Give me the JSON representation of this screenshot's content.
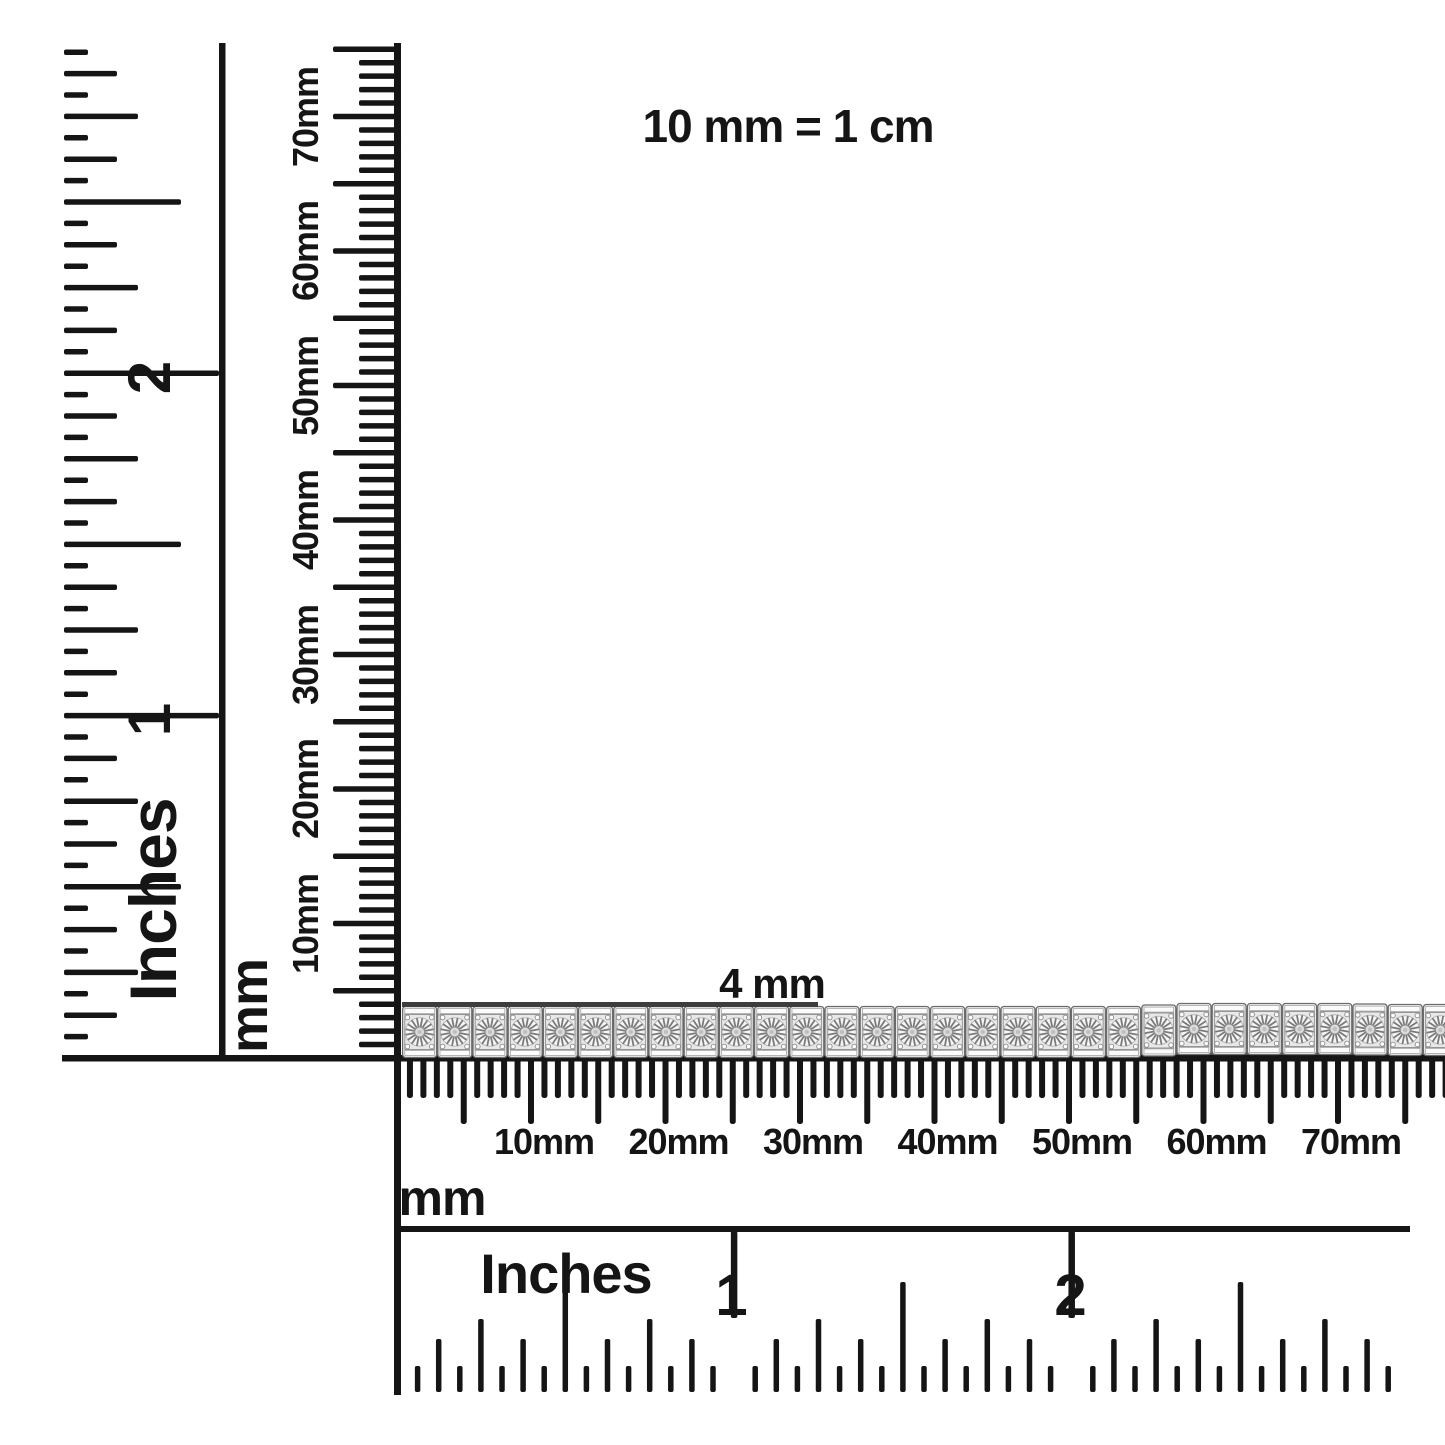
{
  "scale_note": "10 mm = 1 cm",
  "bracelet": {
    "width_label": "4 mm",
    "visible_link_count": 30
  },
  "rulers": {
    "left_inch": {
      "title": "Inches",
      "numbers": [
        "1",
        "2"
      ]
    },
    "left_mm": {
      "title": "mm",
      "tick_labels": [
        "10mm",
        "20mm",
        "30mm",
        "40mm",
        "50mm",
        "60mm",
        "70mm"
      ]
    },
    "bottom_mm": {
      "title": "mm",
      "tick_labels": [
        "10mm",
        "20mm",
        "30mm",
        "40mm",
        "50mm",
        "60mm",
        "70mm"
      ]
    },
    "bottom_inch": {
      "title": "Inches",
      "numbers": [
        "1",
        "2"
      ]
    }
  },
  "colors": {
    "background": "#ffffff",
    "ink": "#151515",
    "measure_line": "#3d3d3d",
    "metal_light": "#f6f6f6",
    "metal_mid": "#dcdcdc",
    "metal_dark": "#7a7a7a"
  }
}
